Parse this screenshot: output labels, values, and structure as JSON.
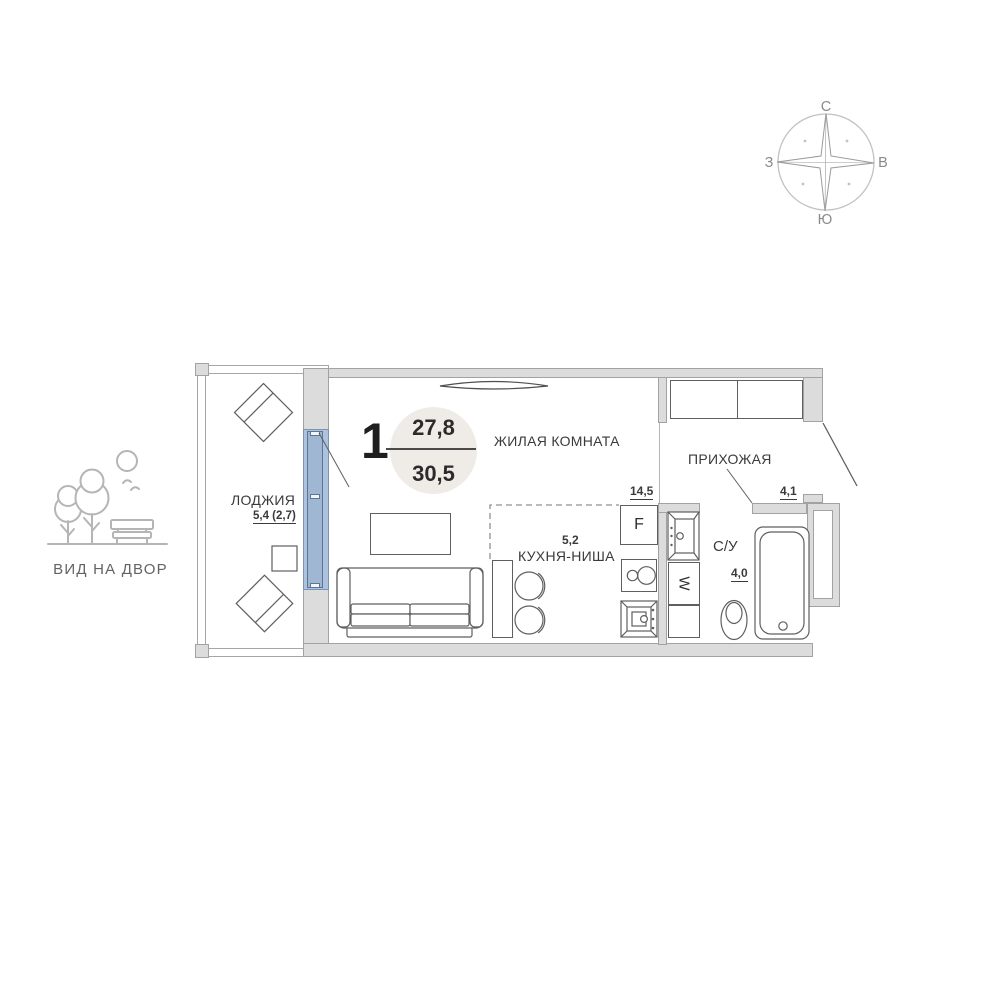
{
  "compass": {
    "north": "С",
    "east": "В",
    "south": "Ю",
    "west": "З"
  },
  "courtyard_view": {
    "label": "ВИД НА ДВОР"
  },
  "plan": {
    "unit": {
      "number": "1",
      "living_area": "27,8",
      "total_area": "30,5"
    },
    "rooms": {
      "living": {
        "name": "ЖИЛАЯ КОМНАТА",
        "area": "14,5"
      },
      "kitchen": {
        "name": "КУХНЯ-НИША",
        "area": "5,2"
      },
      "loggia": {
        "name": "ЛОДЖИЯ",
        "area": "5,4 (2,7)"
      },
      "hallway": {
        "name": "ПРИХОЖАЯ",
        "area": "4,1"
      },
      "bathroom": {
        "name": "С/У",
        "area": "4,0"
      }
    },
    "appliances": {
      "fridge_label": "F",
      "washer_label": "W"
    }
  },
  "colors": {
    "wall_fill": "#dcdcdc",
    "wall_border": "#a2a2a2",
    "glazing_fill": "#adc2dc",
    "glazing_leaf": "#9fb7d3",
    "glazing_border": "#6d89a8",
    "badge_bg": "#efebe6",
    "line": "#5f5f5f",
    "icon_stroke": "#b5b5b5"
  }
}
